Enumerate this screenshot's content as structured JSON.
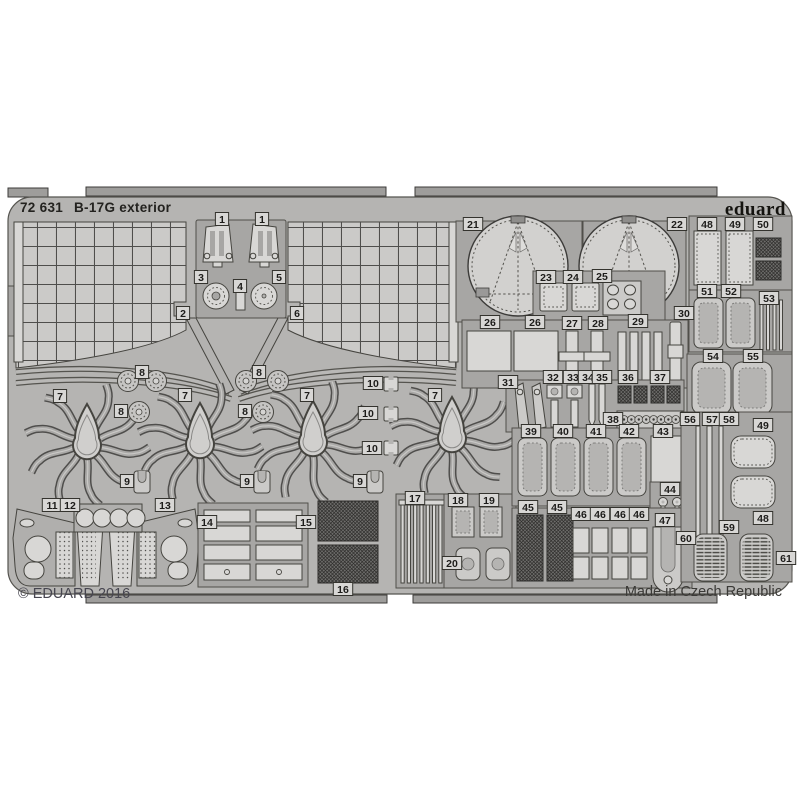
{
  "sheet": {
    "catalog_number": "72 631",
    "title": "B-17G exterior",
    "brand": "eduard",
    "copyright": "© EDUARD 2016",
    "made_in": "Made in Czech Republic"
  },
  "colors": {
    "background": "#ffffff",
    "fret_base": "#b5b4b2",
    "part_light": "#cbcac8",
    "part_lighter": "#d8d7d5",
    "plate_dark": "#a7a6a4",
    "panel_mid": "#b0afad",
    "outline": "#45443f",
    "line_dark": "#55544f",
    "text_dark": "#23221f",
    "text_grey": "#474650"
  },
  "part_labels": [
    {
      "n": "1",
      "x": 222,
      "y": 219
    },
    {
      "n": "1",
      "x": 262,
      "y": 219
    },
    {
      "n": "2",
      "x": 183,
      "y": 313
    },
    {
      "n": "3",
      "x": 201,
      "y": 277
    },
    {
      "n": "4",
      "x": 240,
      "y": 286
    },
    {
      "n": "5",
      "x": 279,
      "y": 277
    },
    {
      "n": "6",
      "x": 297,
      "y": 313
    },
    {
      "n": "7",
      "x": 60,
      "y": 396
    },
    {
      "n": "7",
      "x": 185,
      "y": 395
    },
    {
      "n": "7",
      "x": 307,
      "y": 395
    },
    {
      "n": "7",
      "x": 435,
      "y": 395
    },
    {
      "n": "8",
      "x": 142,
      "y": 372
    },
    {
      "n": "8",
      "x": 259,
      "y": 372
    },
    {
      "n": "8",
      "x": 121,
      "y": 411
    },
    {
      "n": "8",
      "x": 245,
      "y": 411
    },
    {
      "n": "9",
      "x": 127,
      "y": 481
    },
    {
      "n": "9",
      "x": 247,
      "y": 481
    },
    {
      "n": "9",
      "x": 360,
      "y": 481
    },
    {
      "n": "10",
      "x": 373,
      "y": 383
    },
    {
      "n": "10",
      "x": 368,
      "y": 413
    },
    {
      "n": "10",
      "x": 372,
      "y": 448
    },
    {
      "n": "11",
      "x": 52,
      "y": 505
    },
    {
      "n": "12",
      "x": 70,
      "y": 505
    },
    {
      "n": "13",
      "x": 165,
      "y": 505
    },
    {
      "n": "14",
      "x": 207,
      "y": 522
    },
    {
      "n": "15",
      "x": 306,
      "y": 522
    },
    {
      "n": "16",
      "x": 343,
      "y": 589
    },
    {
      "n": "17",
      "x": 415,
      "y": 498
    },
    {
      "n": "18",
      "x": 458,
      "y": 500
    },
    {
      "n": "19",
      "x": 489,
      "y": 500
    },
    {
      "n": "20",
      "x": 452,
      "y": 563
    },
    {
      "n": "21",
      "x": 473,
      "y": 224
    },
    {
      "n": "22",
      "x": 677,
      "y": 224
    },
    {
      "n": "23",
      "x": 546,
      "y": 277
    },
    {
      "n": "24",
      "x": 573,
      "y": 277
    },
    {
      "n": "25",
      "x": 602,
      "y": 276
    },
    {
      "n": "26",
      "x": 490,
      "y": 322
    },
    {
      "n": "26",
      "x": 535,
      "y": 322
    },
    {
      "n": "27",
      "x": 572,
      "y": 323
    },
    {
      "n": "28",
      "x": 598,
      "y": 323
    },
    {
      "n": "29",
      "x": 638,
      "y": 321
    },
    {
      "n": "30",
      "x": 684,
      "y": 313
    },
    {
      "n": "31",
      "x": 508,
      "y": 382
    },
    {
      "n": "32",
      "x": 553,
      "y": 377
    },
    {
      "n": "33",
      "x": 573,
      "y": 377
    },
    {
      "n": "34",
      "x": 588,
      "y": 377
    },
    {
      "n": "35",
      "x": 602,
      "y": 377
    },
    {
      "n": "36",
      "x": 628,
      "y": 377
    },
    {
      "n": "37",
      "x": 660,
      "y": 377
    },
    {
      "n": "38",
      "x": 613,
      "y": 419
    },
    {
      "n": "39",
      "x": 531,
      "y": 431
    },
    {
      "n": "40",
      "x": 563,
      "y": 431
    },
    {
      "n": "41",
      "x": 596,
      "y": 431
    },
    {
      "n": "42",
      "x": 629,
      "y": 431
    },
    {
      "n": "43",
      "x": 663,
      "y": 431
    },
    {
      "n": "44",
      "x": 670,
      "y": 489
    },
    {
      "n": "45",
      "x": 528,
      "y": 507
    },
    {
      "n": "45",
      "x": 557,
      "y": 507
    },
    {
      "n": "46",
      "x": 581,
      "y": 514
    },
    {
      "n": "46",
      "x": 600,
      "y": 514
    },
    {
      "n": "46",
      "x": 620,
      "y": 514
    },
    {
      "n": "46",
      "x": 639,
      "y": 514
    },
    {
      "n": "47",
      "x": 665,
      "y": 520
    },
    {
      "n": "48",
      "x": 707,
      "y": 224
    },
    {
      "n": "49",
      "x": 735,
      "y": 224
    },
    {
      "n": "50",
      "x": 763,
      "y": 224
    },
    {
      "n": "51",
      "x": 707,
      "y": 291
    },
    {
      "n": "52",
      "x": 731,
      "y": 291
    },
    {
      "n": "53",
      "x": 769,
      "y": 298
    },
    {
      "n": "54",
      "x": 713,
      "y": 356
    },
    {
      "n": "55",
      "x": 753,
      "y": 356
    },
    {
      "n": "56",
      "x": 690,
      "y": 419
    },
    {
      "n": "57",
      "x": 712,
      "y": 419
    },
    {
      "n": "58",
      "x": 729,
      "y": 419
    },
    {
      "n": "49",
      "x": 763,
      "y": 425
    },
    {
      "n": "48",
      "x": 763,
      "y": 518
    },
    {
      "n": "59",
      "x": 729,
      "y": 527
    },
    {
      "n": "60",
      "x": 686,
      "y": 538
    },
    {
      "n": "61",
      "x": 786,
      "y": 558
    }
  ]
}
